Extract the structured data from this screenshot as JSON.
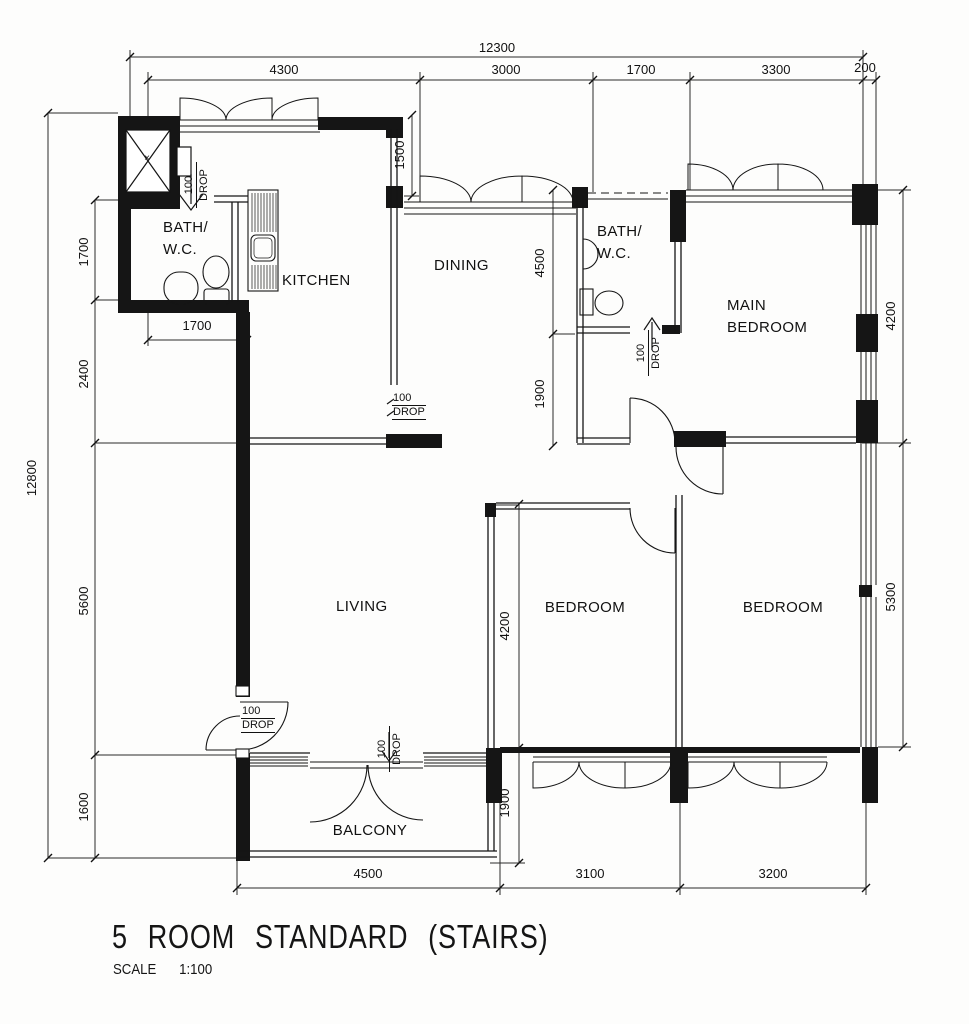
{
  "title": {
    "main": "5 ROOM STANDARD (STAIRS)",
    "scale_label": "SCALE",
    "scale_value": "1:100"
  },
  "rooms": {
    "bath1_l1": "BATH/",
    "bath1_l2": "W.C.",
    "kitchen": "KITCHEN",
    "dining": "DINING",
    "bath2_l1": "BATH/",
    "bath2_l2": "W.C.",
    "main_bedroom_l1": "MAIN",
    "main_bedroom_l2": "BEDROOM",
    "living": "LIVING",
    "bedroom_mid": "BEDROOM",
    "bedroom_right": "BEDROOM",
    "balcony": "BALCONY"
  },
  "dims": {
    "top_total": "12300",
    "top_chain": [
      "4300",
      "3000",
      "1700",
      "3300",
      "200"
    ],
    "left_total": "12800",
    "left_chain": [
      "1700",
      "2400",
      "5600",
      "1600"
    ],
    "right_chain": [
      "4200",
      "5300"
    ],
    "bottom_chain": [
      "4500",
      "3100",
      "3200"
    ],
    "bath_width": "1700",
    "kitchen_recess": "1500",
    "dining_depth": "4500",
    "corridor_depth": "1900",
    "bedroom_depth": "4200",
    "balcony_depth": "1900"
  },
  "drop": {
    "value": "100",
    "word": "DROP"
  },
  "markers": {
    "lift_x": "×"
  }
}
